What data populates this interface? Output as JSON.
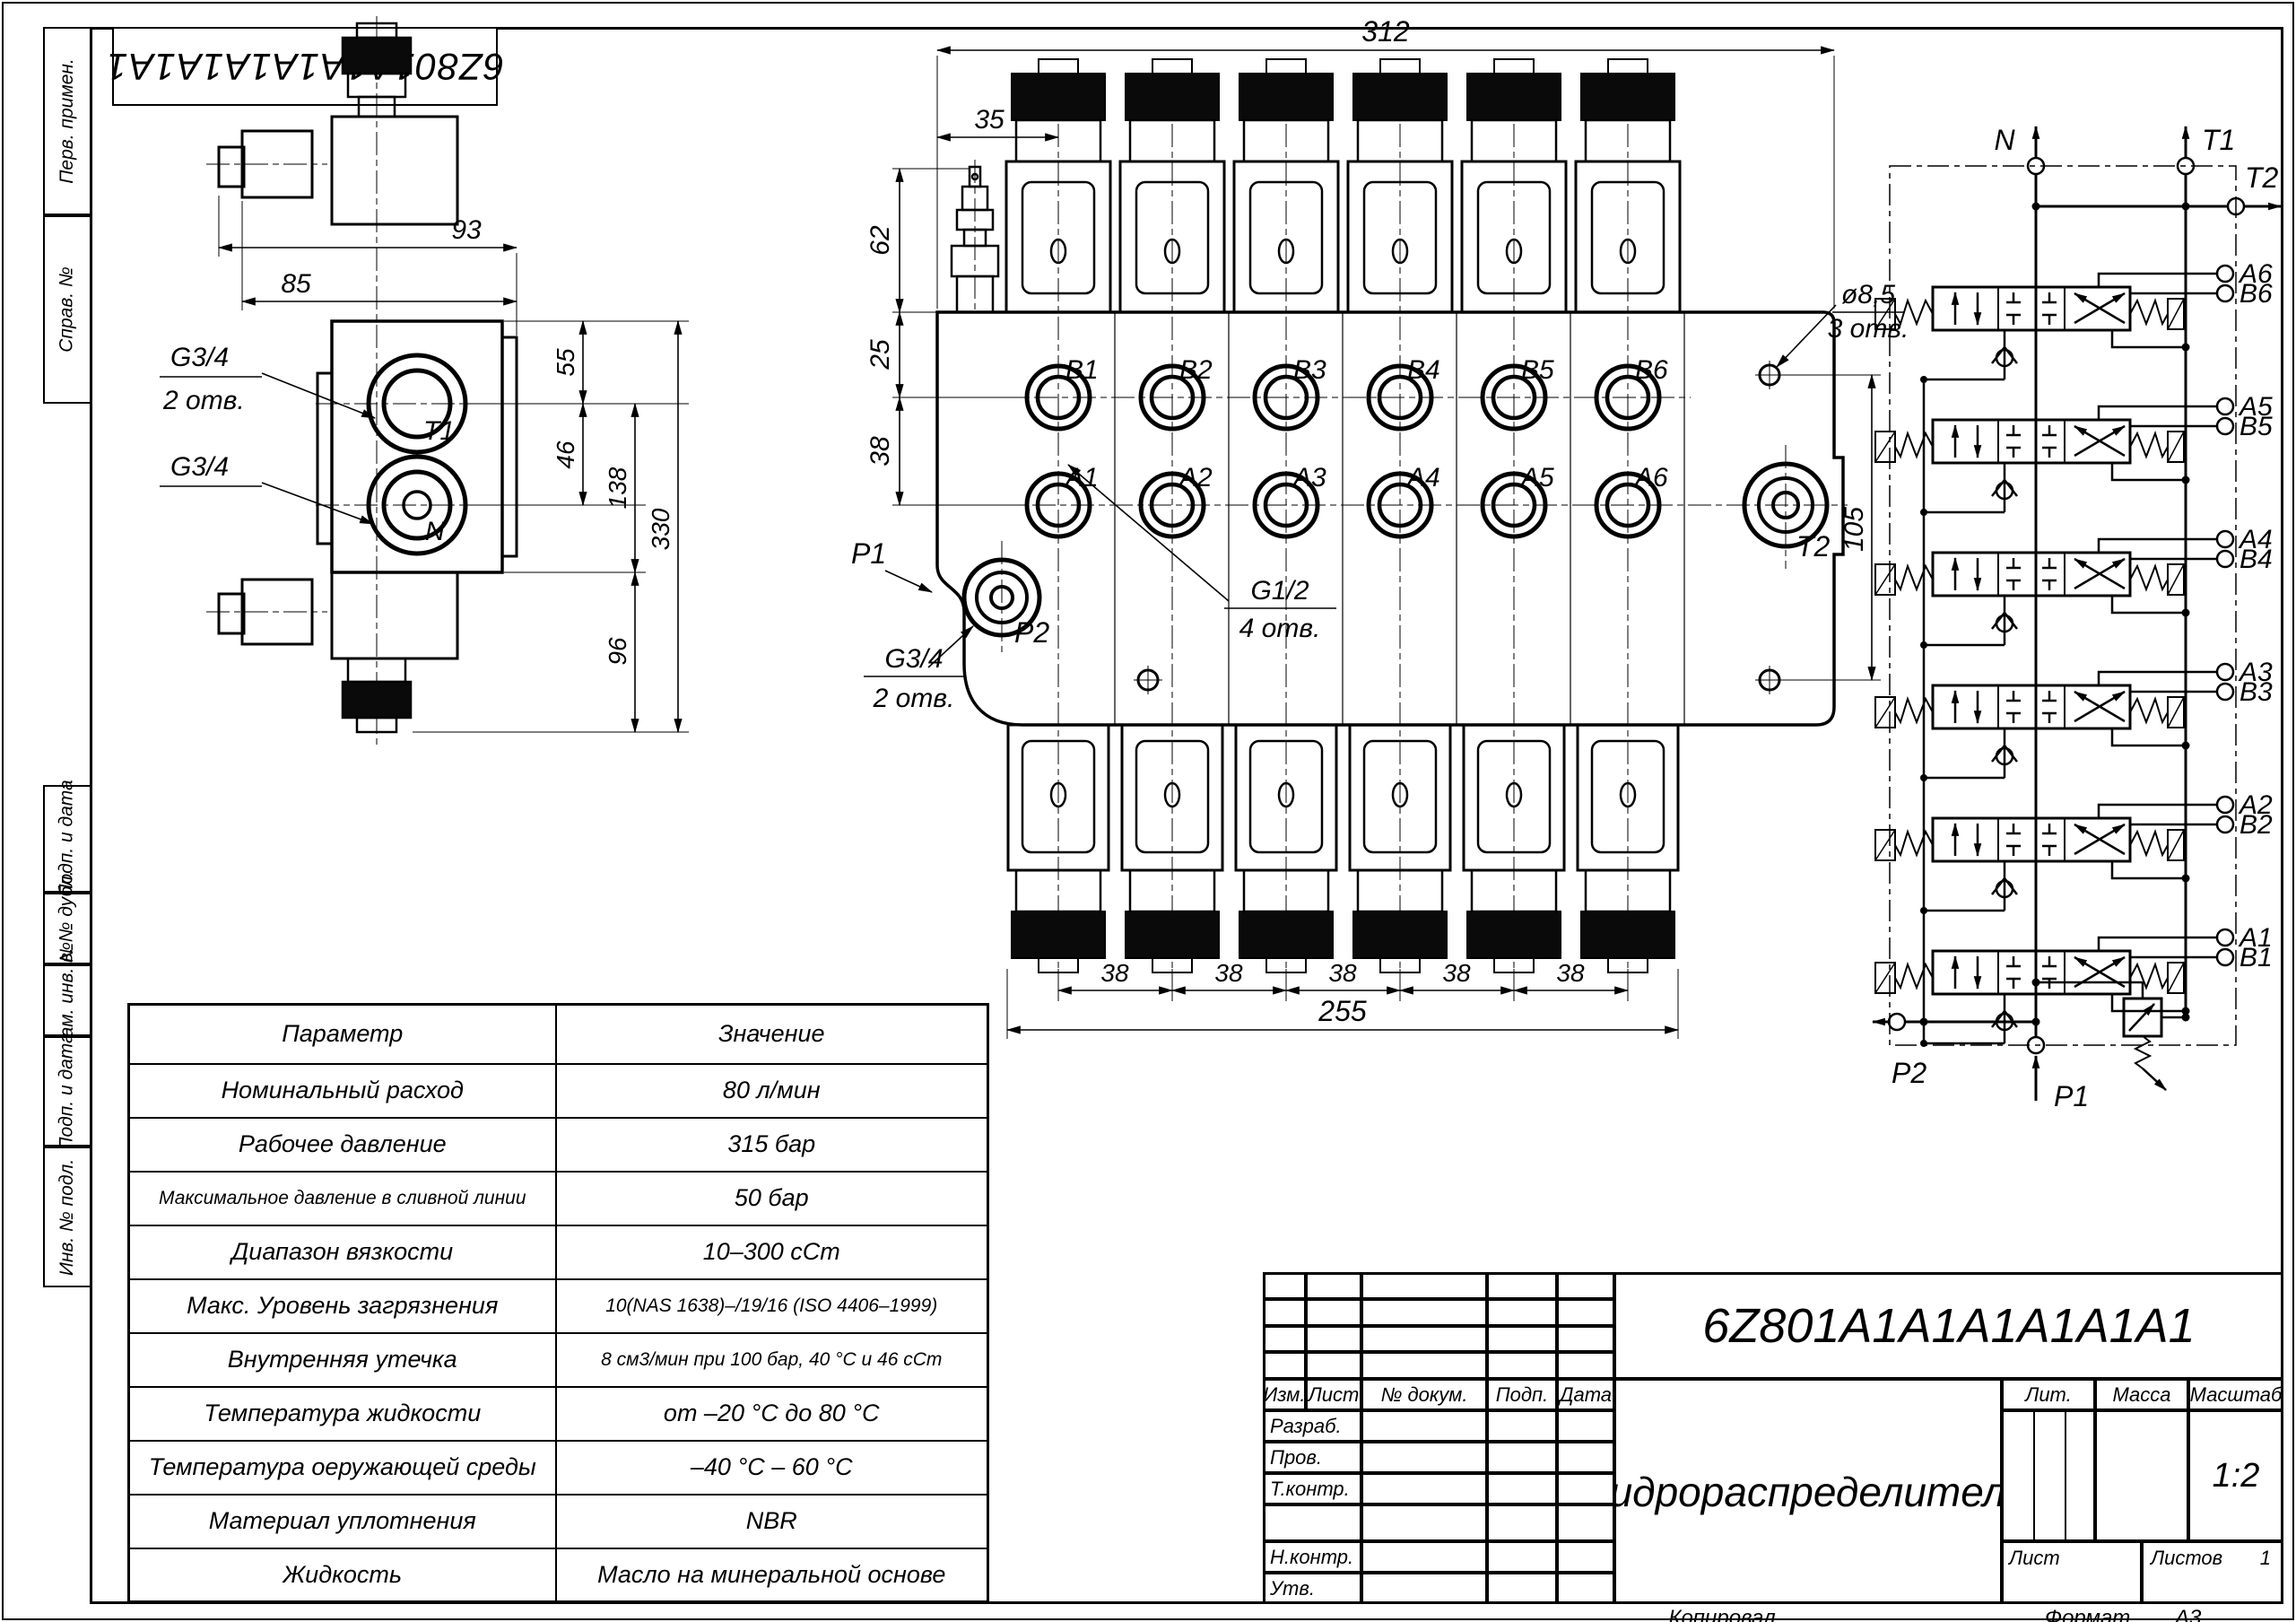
{
  "page": {
    "top_code": "6Z801A1A1A1A1A1A1",
    "footer": {
      "copied": "Копировал",
      "format_label": "Формат",
      "format_value": "А3"
    }
  },
  "sidebar": {
    "labels": [
      "Перв. примен.",
      "Справ. №",
      "Подп. и дата",
      "Инв. № дубл.",
      "Взам. инв. №",
      "Подп. и дата",
      "Инв. № подл."
    ]
  },
  "params_table": {
    "headers": [
      "Параметр",
      "Значение"
    ],
    "rows": [
      [
        "Номинальный расход",
        "80 л/мин"
      ],
      [
        "Рабочее давление",
        "315 бар"
      ],
      [
        "Максимальное давление в сливной линии",
        "50 бар"
      ],
      [
        "Диапазон вязкости",
        "10–300 сСт"
      ],
      [
        "Макс. Уровень загрязнения",
        "10(NAS 1638)–/19/16 (ISO 4406–1999)"
      ],
      [
        "Внутренняя утечка",
        "8 см3/мин при 100 бар, 40 °С и 46 сСт"
      ],
      [
        "Температура жидкости",
        "от –20 °С до 80 °С"
      ],
      [
        "Температура оеружающей среды",
        "–40 °С – 60 °С"
      ],
      [
        "Материал уплотнения",
        "NBR"
      ],
      [
        "Жидкость",
        "Масло на минеральной основе"
      ]
    ]
  },
  "title_block": {
    "code": "6Z801A1A1A1A1A1A1",
    "name": "Гидрораспределитель",
    "cols": [
      "Изм.",
      "Лист",
      "№ докум.",
      "Подп.",
      "Дата"
    ],
    "rows": [
      "Разраб.",
      "Пров.",
      "Т.контр.",
      "Н.контр.",
      "Утв."
    ],
    "lit_label": "Лит.",
    "mass_label": "Масса",
    "scale_label": "Масштаб",
    "scale_value": "1:2",
    "sheet_label": "Лист",
    "sheets_label": "Листов",
    "sheets_value": "1"
  },
  "front_view": {
    "dims": {
      "total": "312",
      "offset": "35",
      "h62": "62",
      "h25": "25",
      "h38": "38",
      "right": "105",
      "bottom": "255",
      "pitch": [
        "38",
        "38",
        "38",
        "38",
        "38"
      ]
    },
    "ports_b": [
      "B1",
      "B2",
      "B3",
      "B4",
      "B5",
      "B6"
    ],
    "ports_a": [
      "A1",
      "A2",
      "A3",
      "A4",
      "A5",
      "A6"
    ],
    "labels": {
      "p1": "P1",
      "p2": "P2",
      "t2": "T2",
      "hole_dia": "ø8,5",
      "hole_count": "3 отв.",
      "g12": "G1/2",
      "g12_count": "4 отв.",
      "g34": "G3/4",
      "g34_count": "2 отв."
    }
  },
  "side_view": {
    "dims": {
      "d93": "93",
      "d85": "85",
      "d55": "55",
      "d46": "46",
      "d138": "138",
      "d330": "330",
      "d96": "96"
    },
    "labels": {
      "t1": "T1",
      "n": "N",
      "g34_top": "G3/4",
      "g34_top_count": "2 отв.",
      "g34_bottom": "G3/4"
    }
  },
  "schematic": {
    "labels": {
      "n": "N",
      "t1": "T1",
      "t2": "T2",
      "p1": "P1",
      "p2": "P2"
    },
    "sections": [
      {
        "a": "A6",
        "b": "B6"
      },
      {
        "a": "A5",
        "b": "B5"
      },
      {
        "a": "A4",
        "b": "B4"
      },
      {
        "a": "A3",
        "b": "B3"
      },
      {
        "a": "A2",
        "b": "B2"
      },
      {
        "a": "A1",
        "b": "B1"
      }
    ]
  }
}
